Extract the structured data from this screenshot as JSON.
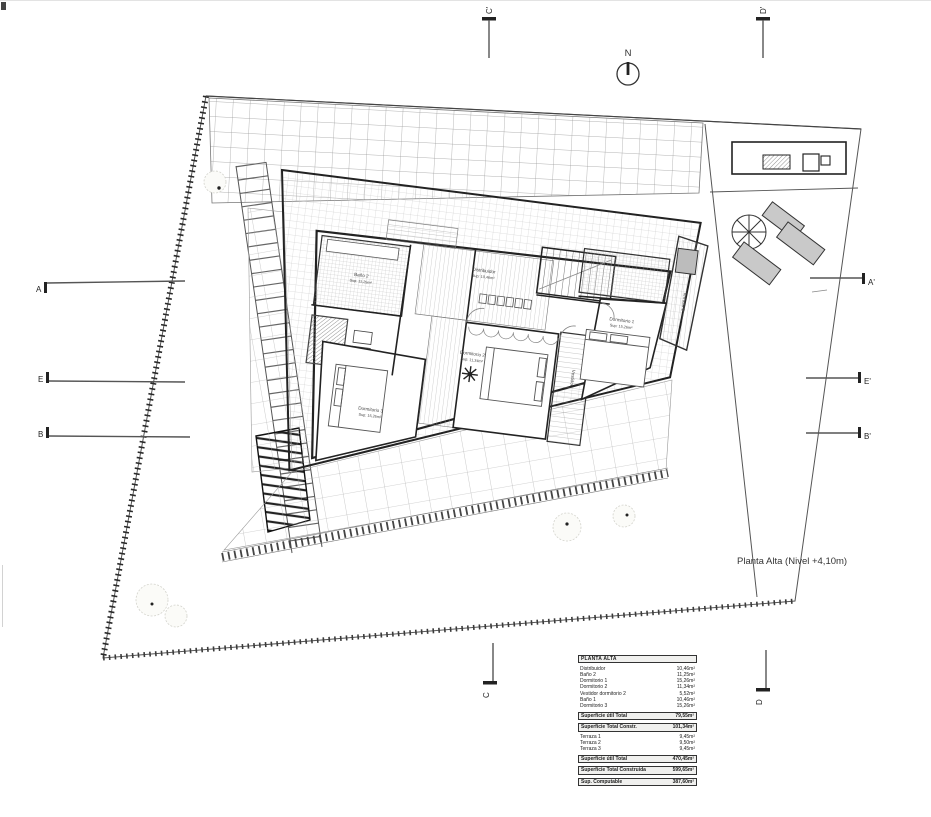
{
  "title": "Planta Alta (Nivel +4,10m)",
  "north_label": "N",
  "colors": {
    "ink": "#222222",
    "lounger_fill": "#c9c9c9",
    "tile_line": "#a8a8a8"
  },
  "section_markers": {
    "left": [
      "A",
      "E",
      "B"
    ],
    "right": [
      "A'",
      "E'",
      "B'"
    ],
    "top": [
      "C'",
      "D'"
    ],
    "bottom": [
      "C",
      "D"
    ]
  },
  "rooms": {
    "bano2": {
      "name": "Baño 2",
      "sup": "Sup: 11,25m²"
    },
    "distribuidor": {
      "name": "Distribuidor",
      "sup": "Sup: 10,46m²"
    },
    "dormitorio2": {
      "name": "Dormitorio 2",
      "sup": "Sup: 11,34m²"
    },
    "dormitorio3": {
      "name": "Dormitorio 3",
      "sup": "Sup: 15,26m²"
    },
    "dormitorio1": {
      "name": "Dormitorio 1",
      "sup": "Sup: 15,26m²"
    },
    "vestidor": {
      "name": "Vestidor"
    },
    "terraza1": {
      "name": "Terraza 1"
    }
  },
  "table": {
    "header": "PLANTA ALTA",
    "rooms": [
      {
        "label": "Distribuidor",
        "value": "10,46m²"
      },
      {
        "label": "Baño 2",
        "value": "11,25m²"
      },
      {
        "label": "Dormitorio 1",
        "value": "15,26m²"
      },
      {
        "label": "Dormitorio 2",
        "value": "11,34m²"
      },
      {
        "label": "Vestidor dormitorio 2",
        "value": "5,52m²"
      },
      {
        "label": "Baño 1",
        "value": "10,46m²"
      },
      {
        "label": "Dormitorio 3",
        "value": "15,26m²"
      }
    ],
    "util_total": {
      "label": "Superficie útil Total",
      "value": "79,55m²"
    },
    "constr_total": {
      "label": "Superficie Total Constr.",
      "value": "101,34m²"
    },
    "terraces": [
      {
        "label": "Terraza 1",
        "value": "9,45m²"
      },
      {
        "label": "Terraza 2",
        "value": "9,50m²"
      },
      {
        "label": "Terraza 3",
        "value": "9,45m²"
      }
    ],
    "util_total2": {
      "label": "Superficie útil Total",
      "value": "470,45m²"
    },
    "constr_total2": {
      "label": "Superficie Total Construida",
      "value": "599,65m²"
    },
    "computable": {
      "label": "Sup. Computable",
      "value": "387,60m²"
    }
  }
}
